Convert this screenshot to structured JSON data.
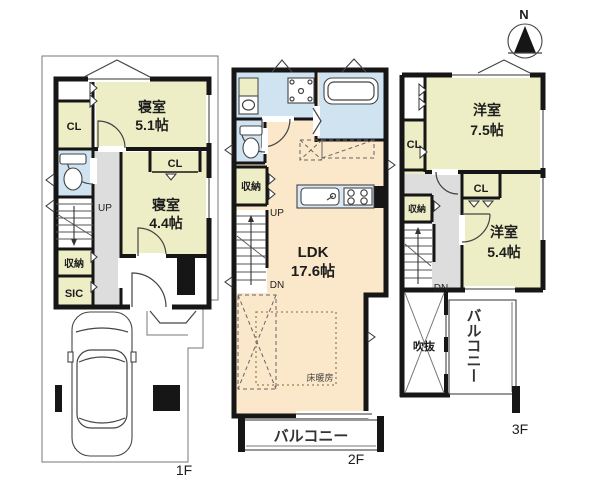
{
  "colors": {
    "room": "#edeec6",
    "ldk": "#fbe7c9",
    "wet": "#cfe3f1",
    "hall": "#dcdddc",
    "counter": "#dbe8f4",
    "hatch": "#e7ebc5"
  },
  "compass": {
    "north": "N"
  },
  "floor1": {
    "label": "1F",
    "bedroom1_name": "寝室",
    "bedroom1_size": "5.1帖",
    "bedroom2_name": "寝室",
    "bedroom2_size": "4.4帖",
    "closet1": "CL",
    "closet2": "CL",
    "storage": "収納",
    "shoe_closet": "SIC",
    "stairs_up": "UP"
  },
  "floor2": {
    "label": "2F",
    "ldk_name": "LDK",
    "ldk_size": "17.6帖",
    "storage": "収納",
    "stairs_up": "UP",
    "stairs_down": "DN",
    "floor_heating": "床暖房",
    "balcony": "バルコニー"
  },
  "floor3": {
    "label": "3F",
    "room1_name": "洋室",
    "room1_size": "7.5帖",
    "room2_name": "洋室",
    "room2_size": "5.4帖",
    "closet1": "CL",
    "closet2": "CL",
    "storage": "収納",
    "stairs_down": "DN",
    "void": "吹抜",
    "balcony": "バルコニー"
  }
}
